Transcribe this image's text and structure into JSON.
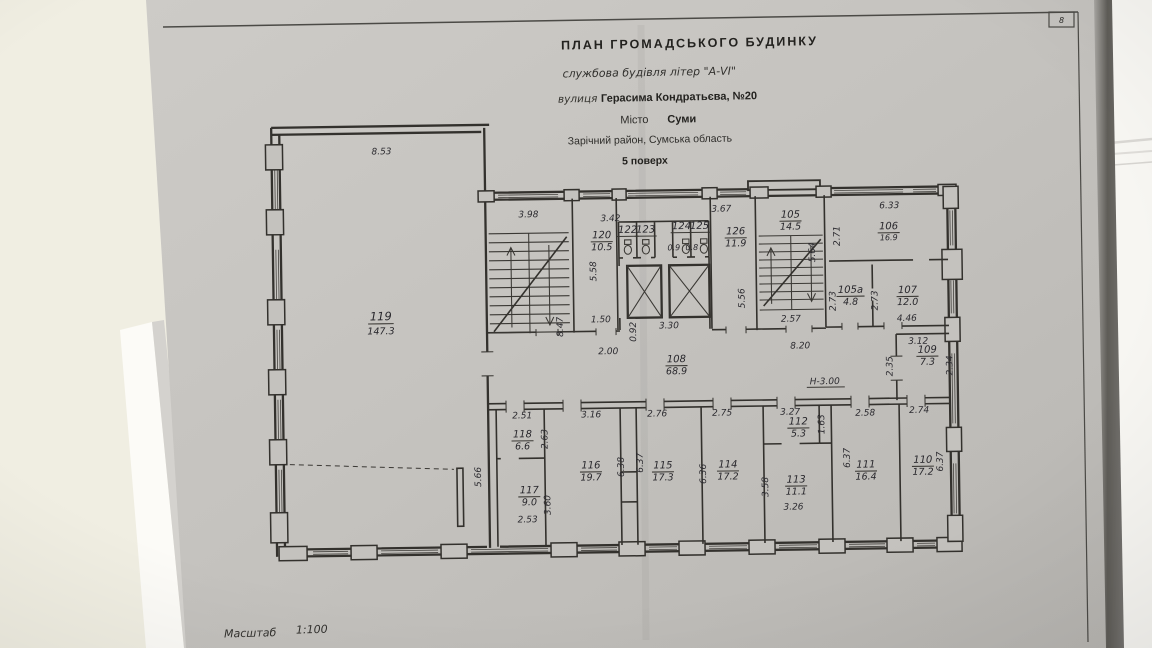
{
  "page": {
    "corner_number": "8",
    "scale_label": "Масштаб",
    "scale_value": "1:100"
  },
  "title": {
    "line1": "ПЛАН  ГРОМАДСЬКОГО  БУДИНКУ",
    "line2": "службова будівля літер \"А-VI\"",
    "street_label": "вулиця",
    "street_value": "Герасима Кондратьєва, №20",
    "city_label": "Місто",
    "city_value": "Суми",
    "district": "Зарічний район, Сумська область",
    "floor": "5 поверх"
  },
  "rooms": {
    "r119": {
      "num": "119",
      "area": "147.3"
    },
    "r120": {
      "num": "120",
      "area": "10.5"
    },
    "r122": {
      "num": "122"
    },
    "r123": {
      "num": "123"
    },
    "r124": {
      "num": "124",
      "area": "0.9"
    },
    "r125": {
      "num": "125",
      "area": "0.8"
    },
    "r126": {
      "num": "126",
      "area": "11.9"
    },
    "r105": {
      "num": "105",
      "area": "14.5"
    },
    "r106": {
      "num": "106",
      "area": "16.9"
    },
    "r105a": {
      "num": "105а",
      "area": "4.8"
    },
    "r107": {
      "num": "107",
      "area": "12.0"
    },
    "r108": {
      "num": "108",
      "area": "68.9"
    },
    "r109": {
      "num": "109",
      "area": "7.3"
    },
    "r110": {
      "num": "110",
      "area": "17.2"
    },
    "r111": {
      "num": "111",
      "area": "16.4"
    },
    "r112": {
      "num": "112",
      "area": "5.3"
    },
    "r113": {
      "num": "113",
      "area": "11.1"
    },
    "r114": {
      "num": "114",
      "area": "17.2"
    },
    "r115": {
      "num": "115",
      "area": "17.3"
    },
    "r116": {
      "num": "116",
      "area": "19.7"
    },
    "r117": {
      "num": "117",
      "area": "9.0"
    },
    "r118": {
      "num": "118",
      "area": "6.6"
    }
  },
  "dims": {
    "d8_53": "8.53",
    "d3_98": "3.98",
    "d8_47": "8.47",
    "d3_42": "3.42",
    "d5_58": "5.58",
    "d1_50": "1.50",
    "d0_92": "0.92",
    "d3_30": "3.30",
    "d3_67": "3.67",
    "d5_56": "5.56",
    "d2_57": "2.57",
    "d5_64": "5.64",
    "d6_33": "6.33",
    "d2_71": "2.71",
    "d2_73a": "2.73",
    "d2_73b": "2.73",
    "d4_46": "4.46",
    "d2_00": "2.00",
    "d8_20": "8.20",
    "height_note": "Н-3.00",
    "d2_35": "2.35",
    "d3_12": "3.12",
    "d2_34": "2.34",
    "d2_51": "2.51",
    "d2_63": "2.63",
    "d5_66": "5.66",
    "d2_53": "2.53",
    "d3_60": "3.60",
    "d3_16": "3.16",
    "d6_38": "6.38",
    "d6_37a": "6.37",
    "d2_76": "2.76",
    "d6_36": "6.36",
    "d2_75": "2.75",
    "d3_27": "3.27",
    "d1_63": "1.63",
    "d3_58": "3.58",
    "d3_26": "3.26",
    "d2_58": "2.58",
    "d6_37b": "6.37",
    "d2_74": "2.74",
    "d6_37c": "6.37"
  }
}
